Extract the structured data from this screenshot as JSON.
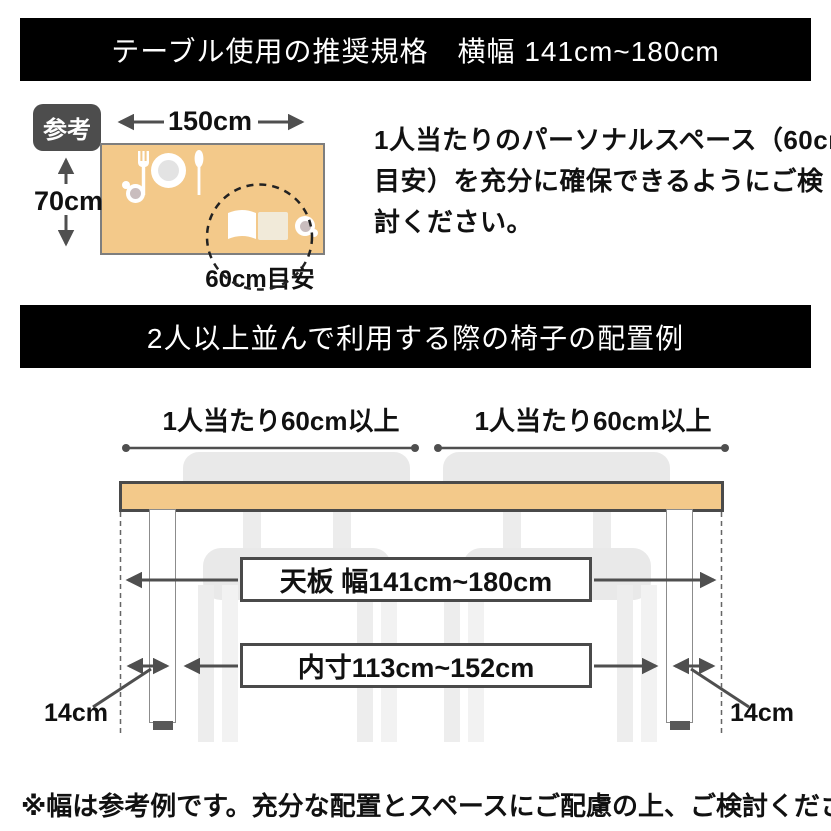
{
  "banners": {
    "top": "テーブル使用の推奨規格　横幅 141cm~180cm",
    "middle": "2人以上並んで利用する際の椅子の配置例"
  },
  "reference": {
    "badge": "参考",
    "table_width": "150cm",
    "table_depth": "70cm",
    "personal_space": "60cm目安",
    "note_lines": [
      "1人当たりのパーソナルスペース（60cm",
      "目安）を充分に確保できるようにご検",
      "討ください。"
    ]
  },
  "layout_example": {
    "per_person_left": "1人当たり60cm以上",
    "per_person_right": "1人当たり60cm以上",
    "tabletop_width": "天板 幅141cm~180cm",
    "inner_width": "内寸113cm~152cm",
    "leg_inset_left": "14cm",
    "leg_inset_right": "14cm"
  },
  "footer_note": "※幅は参考例です。充分な配置とスペースにご配慮の上、ご検討ください。",
  "icons": {
    "place_setting": [
      "fork-icon",
      "plate-icon",
      "knife-icon",
      "cup-icon"
    ],
    "personal_space": [
      "book-icon",
      "teacup-icon"
    ]
  },
  "colors": {
    "banner_bg": "#000000",
    "wood": "#f3c98a",
    "line": "#4f4f4f",
    "chair": "#e9e9e9",
    "badge_bg": "#4d4d4d"
  }
}
